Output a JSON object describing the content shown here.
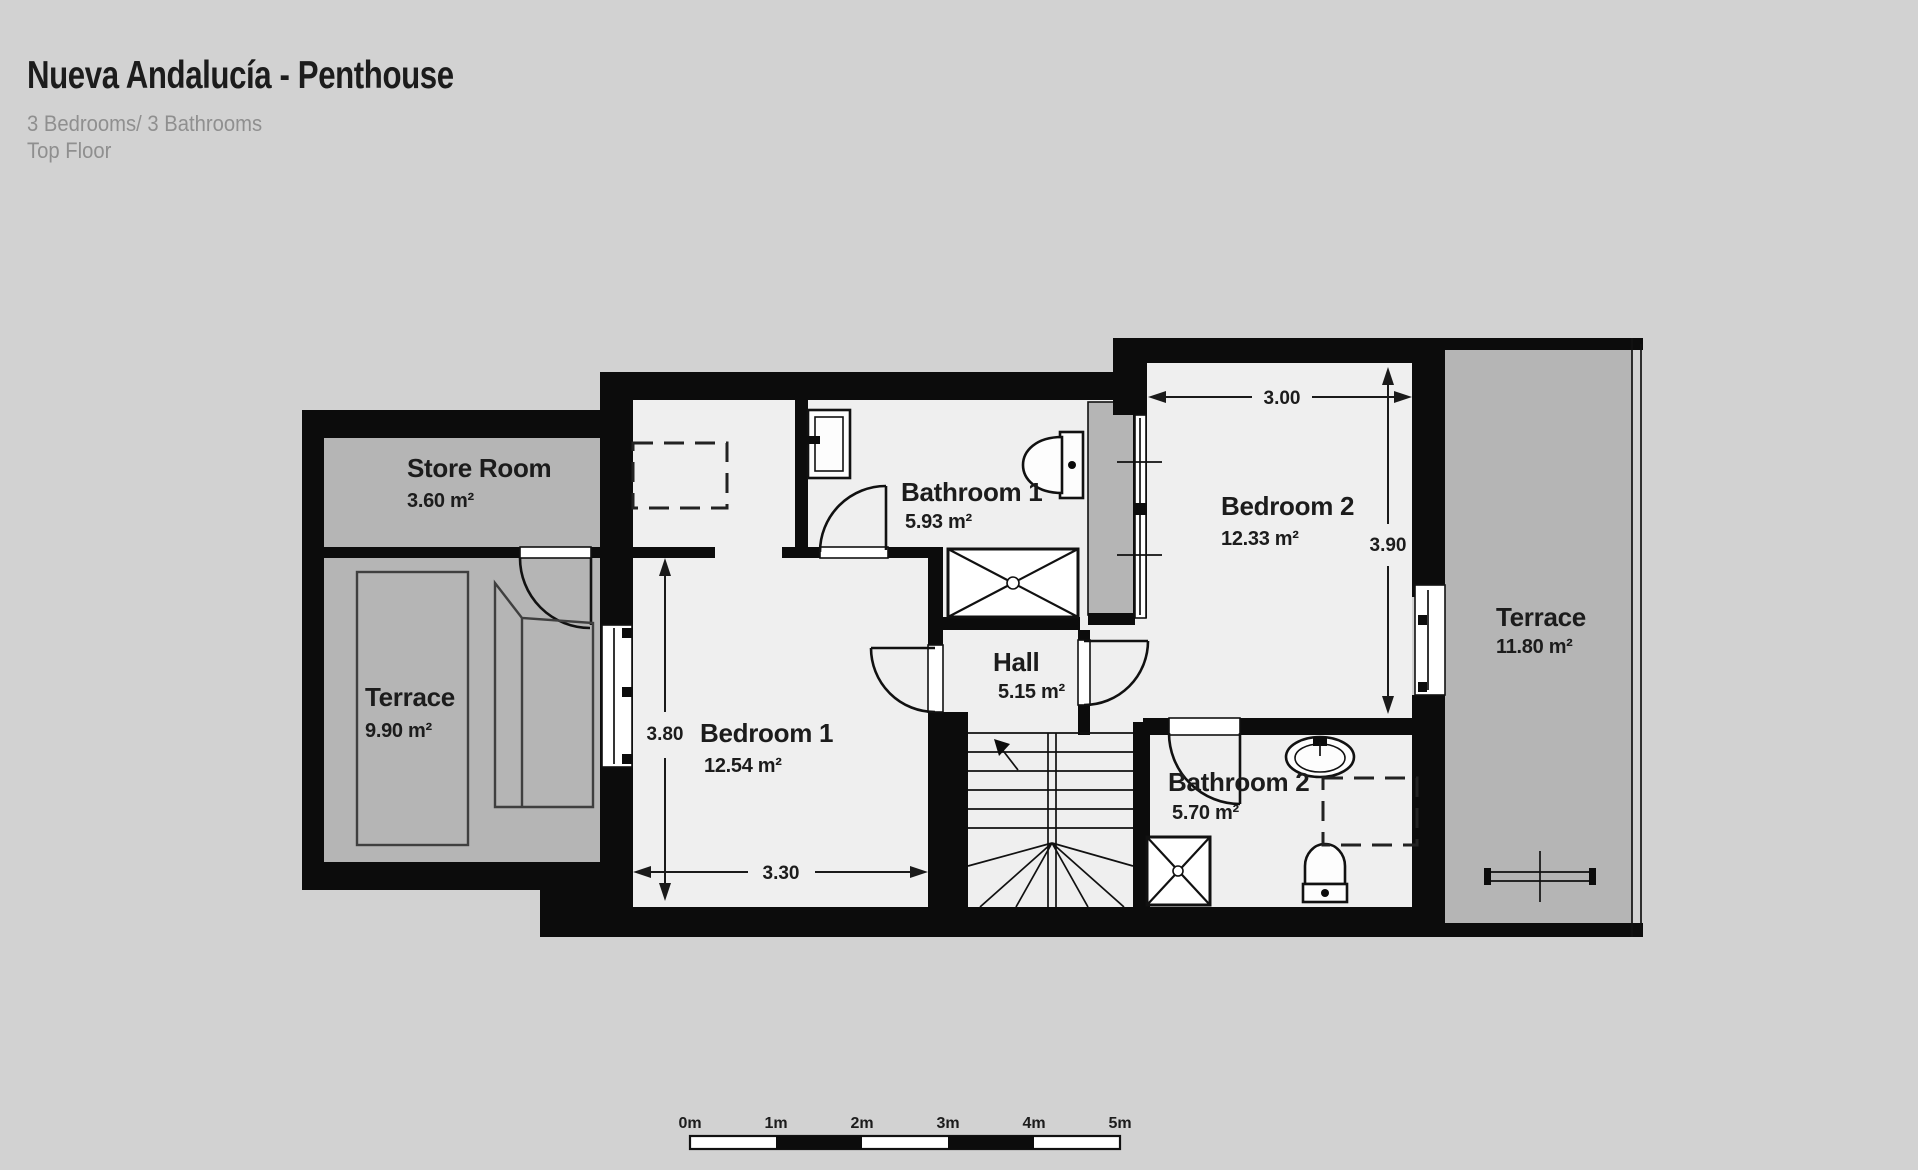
{
  "header": {
    "title": "Nueva Andalucía - Penthouse",
    "subtitle": "3 Bedrooms/ 3 Bathrooms",
    "floor": "Top Floor"
  },
  "rooms": {
    "store_room": {
      "name": "Store Room",
      "area": "3.60 m²"
    },
    "terrace_left": {
      "name": "Terrace",
      "area": "9.90 m²"
    },
    "bedroom_1": {
      "name": "Bedroom 1",
      "area": "12.54 m²"
    },
    "bathroom_1": {
      "name": "Bathroom 1",
      "area": "5.93 m²"
    },
    "hall": {
      "name": "Hall",
      "area": "5.15 m²"
    },
    "bedroom_2": {
      "name": "Bedroom 2",
      "area": "12.33 m²"
    },
    "bathroom_2": {
      "name": "Bathroom 2",
      "area": "5.70 m²"
    },
    "terrace_right": {
      "name": "Terrace",
      "area": "11.80 m²"
    }
  },
  "dimensions": {
    "bedroom_1_width": "3.30",
    "bedroom_1_depth": "3.80",
    "bedroom_2_width": "3.00",
    "bedroom_2_depth": "3.90"
  },
  "scale": {
    "labels": [
      "0m",
      "1m",
      "2m",
      "3m",
      "4m",
      "5m"
    ]
  },
  "colors": {
    "background": "#d2d2d2",
    "floor": "#efefef",
    "terrace_fill": "#b5b5b5",
    "wall": "#0c0c0c",
    "text": "#1c1c1c",
    "muted_text": "#8f8f8f"
  }
}
